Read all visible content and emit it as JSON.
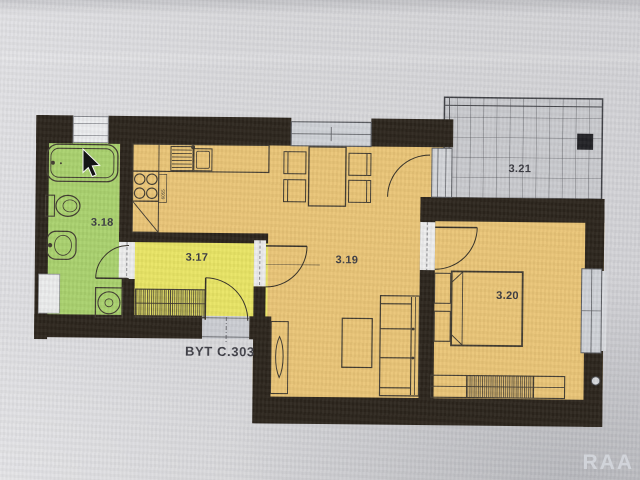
{
  "watermark": "RAA",
  "cursor_icon": "arrow-pointer",
  "plan": {
    "apartment_label": "BYT C.303",
    "rooms": {
      "bathroom": {
        "label": "3.18",
        "name": "bathroom",
        "color": "#a7d069"
      },
      "hallway": {
        "label": "3.17",
        "name": "entrance hall",
        "color": "#e8e45f"
      },
      "living_kitchen": {
        "label": "3.19",
        "name": "living room + kitchen",
        "color": "#e9c372"
      },
      "bedroom": {
        "label": "3.20",
        "name": "bedroom",
        "color": "#e9c372"
      },
      "terrace": {
        "label": "3.21",
        "name": "terrace",
        "color": "#c8c9cd"
      }
    },
    "kitchen_dimension_label": "6055",
    "wall_color": "#251e15",
    "window_color": "#ced1d6",
    "fixtures": {
      "bathroom": [
        "bathtub",
        "toilet",
        "washbasin",
        "washing-machine"
      ],
      "kitchen": [
        "kitchen-counter",
        "dish-drainer",
        "sink",
        "cooktop-4-burners",
        "fridge-space"
      ],
      "hallway": [
        "built-in-wardrobe",
        "entrance-door"
      ],
      "living_room": [
        "dining-table",
        "four-chairs",
        "sofa",
        "coffee-table",
        "radiator",
        "balcony-door",
        "window"
      ],
      "bedroom": [
        "double-bed",
        "nightstand",
        "nightstand",
        "wardrobe",
        "window"
      ],
      "terrace": [
        "tiled-floor",
        "pillar"
      ]
    }
  }
}
